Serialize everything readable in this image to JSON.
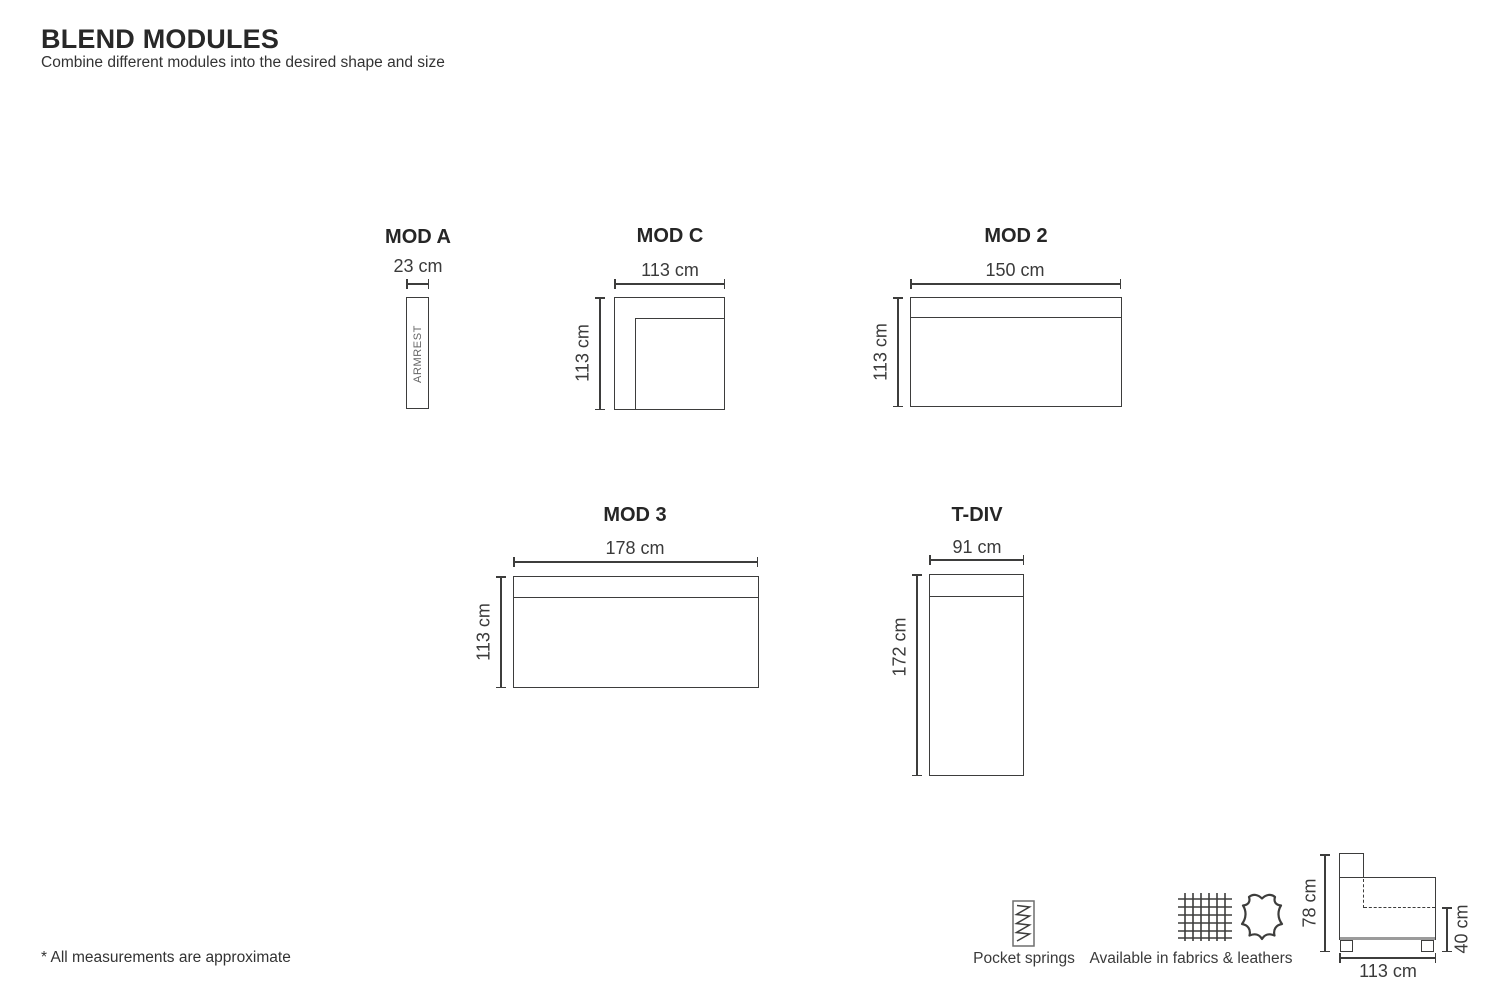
{
  "page": {
    "title": "BLEND MODULES",
    "subtitle": "Combine different modules into the desired shape and size",
    "footnote": "* All measurements are approximate"
  },
  "modules": {
    "mod_a": {
      "name": "MOD A",
      "width_label": "23 cm",
      "body_label": "ARMREST"
    },
    "mod_c": {
      "name": "MOD C",
      "width_label": "113 cm",
      "height_label": "113 cm"
    },
    "mod_2": {
      "name": "MOD 2",
      "width_label": "150 cm",
      "height_label": "113 cm"
    },
    "mod_3": {
      "name": "MOD 3",
      "width_label": "178 cm",
      "height_label": "113 cm"
    },
    "t_div": {
      "name": "T-DIV",
      "width_label": "91 cm",
      "height_label": "172 cm"
    }
  },
  "side_view": {
    "total_height_label": "78 cm",
    "seat_height_label": "40 cm",
    "depth_label": "113 cm"
  },
  "features": {
    "pocket_springs": {
      "icon": "pocket-springs-icon",
      "label": "Pocket springs"
    },
    "materials": {
      "icons": "fabric-icon, leather-icon",
      "label": "Available in fabrics & leathers"
    }
  },
  "colors": {
    "line": "#3d3d3c",
    "text": "#2d2d2d",
    "muted_text": "#646464",
    "base_gray": "#9b9b9b",
    "background": "#ffffff"
  }
}
